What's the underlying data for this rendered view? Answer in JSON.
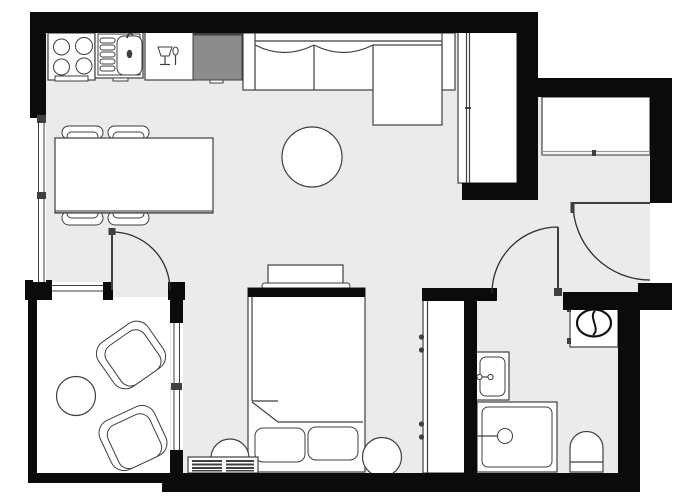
{
  "app": {
    "type": "architectural-floor-plan",
    "view": "top-down",
    "text_labels": []
  },
  "colors": {
    "outside": "#ffffff",
    "wall": "#0b0b0b",
    "floor": "#ebebeb",
    "paper": "#ffffff",
    "line": "#3f3f3f",
    "muted": "#9a9a9a",
    "counter": "#8c8c8c",
    "door": "#2e2e2e"
  },
  "rooms": [
    {
      "name": "living-kitchen-area"
    },
    {
      "name": "sleeping-area"
    },
    {
      "name": "entry-hall"
    },
    {
      "name": "bathroom"
    },
    {
      "name": "balcony"
    }
  ],
  "furniture_icons": [
    "stove-icon",
    "kitchen-sink-icon",
    "dishwasher-icon",
    "countertop",
    "sectional-sofa",
    "chaise-cushion",
    "coffee-table",
    "dining-table",
    "dining-chair",
    "tall-closet",
    "entry-closet",
    "wardrobe",
    "bed",
    "headboard-shelf",
    "pillow",
    "bedside-stool",
    "radiator",
    "lounge-chair",
    "balcony-side-table",
    "washing-machine-icon",
    "bathroom-sink-icon",
    "shower-icon",
    "toilet-icon",
    "door-swing-arc",
    "window-glazing"
  ]
}
